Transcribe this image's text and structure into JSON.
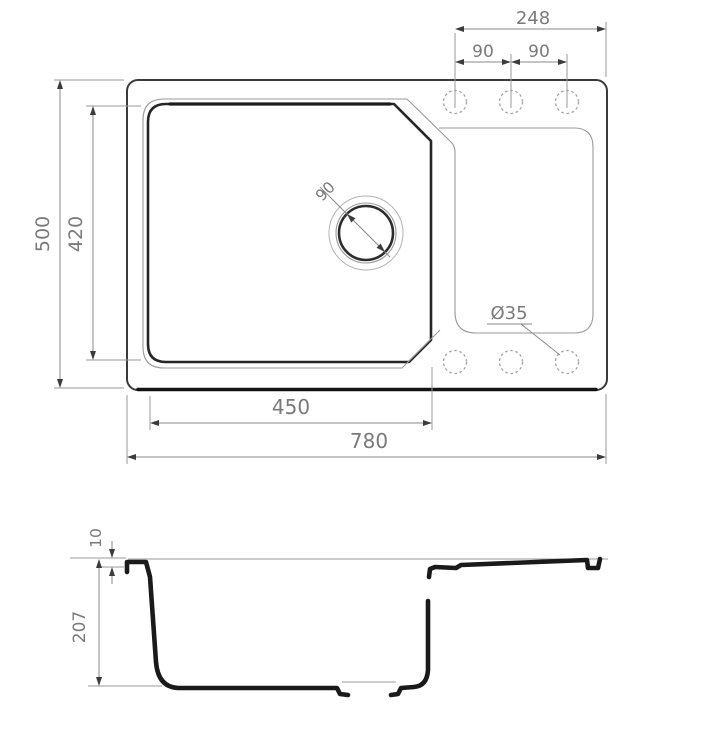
{
  "drawing": {
    "type": "technical-dimension-drawing",
    "views": {
      "top_view_label": "plan view of sink",
      "side_view_label": "section view of sink"
    }
  },
  "top_view": {
    "width_overall": "780",
    "bowl_width": "450",
    "depth_overall": "500",
    "bowl_depth": "420",
    "drain_diameter": "90",
    "hole_diameter": "Ø35",
    "hole_span": "248",
    "hole_spacing_left": "90",
    "hole_spacing_right": "90"
  },
  "side_view": {
    "rim_thickness": "10",
    "bowl_height": "207"
  },
  "colors": {
    "background": "#ffffff",
    "line_dark": "#1a1a1a",
    "line_medium": "#3a3a3a",
    "line_bowl": "#262626",
    "line_light": "#9a9a9a",
    "line_faint": "#b3b3b3",
    "dim_text": "#7a7a7a",
    "arrow": "#3c3c3c"
  }
}
